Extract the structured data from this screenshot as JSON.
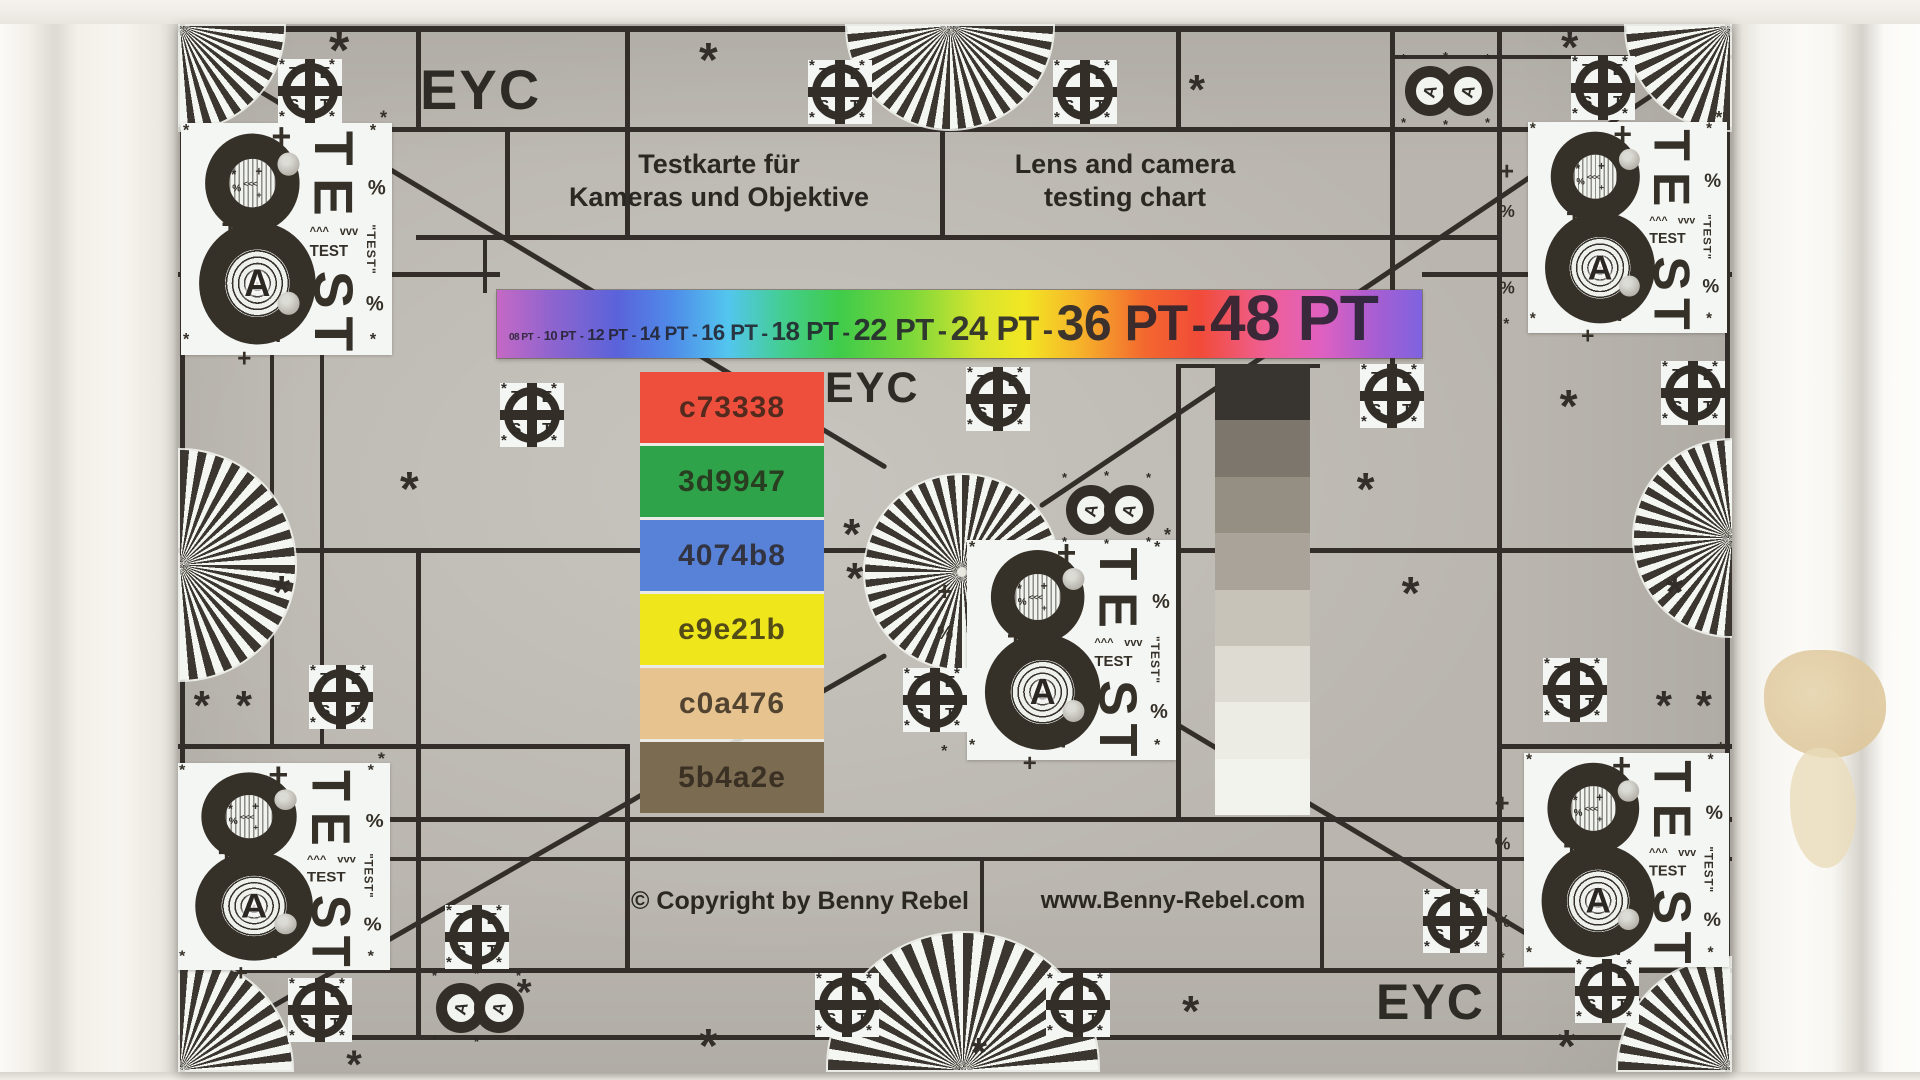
{
  "texts": {
    "eyc_top_left": "EYC",
    "eyc_center": "EYC",
    "eyc_bottom_right": "EYC",
    "title_de_line1": "Testkarte für",
    "title_de_line2": "Kameras und Objektive",
    "title_en_line1": "Lens and camera",
    "title_en_line2": "testing chart",
    "copyright": "© Copyright by Benny Rebel",
    "website": "www.Benny-Rebel.com"
  },
  "font_bar": {
    "labels": [
      {
        "label": "08 PT",
        "px": 10
      },
      {
        "label": "10 PT",
        "px": 13
      },
      {
        "label": "12 PT",
        "px": 16
      },
      {
        "label": "14 PT",
        "px": 19
      },
      {
        "label": "16 PT",
        "px": 22
      },
      {
        "label": "18 PT",
        "px": 26
      },
      {
        "label": "22 PT",
        "px": 31
      },
      {
        "label": "24 PT",
        "px": 34
      },
      {
        "label": "36 PT",
        "px": 50
      },
      {
        "label": "48 PT",
        "px": 64
      }
    ],
    "separator": "-",
    "gradient_stops": [
      "#c569c5 0%",
      "#8e64cf 6%",
      "#5a63da 13%",
      "#4f8ce9 19%",
      "#53c6ee 25%",
      "#43ce8f 31%",
      "#3fcb4a 37%",
      "#7fd83a 45%",
      "#d6e42e 52%",
      "#f2e723 57%",
      "#f6b32a 63%",
      "#f3682f 70%",
      "#f14b38 76%",
      "#ef5f93 83%",
      "#e060c0 89%",
      "#a75ed2 95%",
      "#7e63e0 100%"
    ]
  },
  "color_patches": [
    {
      "label": "c73338",
      "color": "#ee4f3d"
    },
    {
      "label": "3d9947",
      "color": "#2ea34a"
    },
    {
      "label": "4074b8",
      "color": "#5881d8"
    },
    {
      "label": "e9e21b",
      "color": "#efe71c"
    },
    {
      "label": "c0a476",
      "color": "#e7c48f"
    },
    {
      "label": "5b4a2e",
      "color": "#7b6b51"
    }
  ],
  "grayscale_steps": [
    "#38342f",
    "#7c766c",
    "#948e83",
    "#a9a399",
    "#c7c3b9",
    "#dedbd2",
    "#ecebe4",
    "#f3f3ee"
  ],
  "test_target": {
    "letters": [
      "T",
      "E",
      "S",
      "T"
    ],
    "corner_glyph": "*"
  },
  "resolution_block": {
    "digit_label": "8",
    "center_letter": "A",
    "vertical_letters": [
      "T",
      "E",
      "S",
      "T"
    ],
    "small_label": "TEST",
    "side_label": "\"TEST\"",
    "chevrons": "<<<",
    "arrows_up": "^^^",
    "arrows_down": "vvv",
    "plus_glyph": "+",
    "percent_glyph": "%",
    "asterisk_glyph": "*"
  },
  "double_circle": {
    "letter": "A",
    "asterisk_glyph": "*"
  },
  "asterisk_glyph": "*",
  "colors": {
    "chart_bg": "#bab6af",
    "grid_line": "#332e29",
    "wall": "#f3f1eb",
    "patch_white": "#f4f6f3",
    "ray_dark": "#3b3630",
    "ray_light": "#f4f6f1",
    "scuff": "#e3cfa5",
    "text_dark": "#2e2a25",
    "star_center_dot": "#e9e9e1"
  }
}
